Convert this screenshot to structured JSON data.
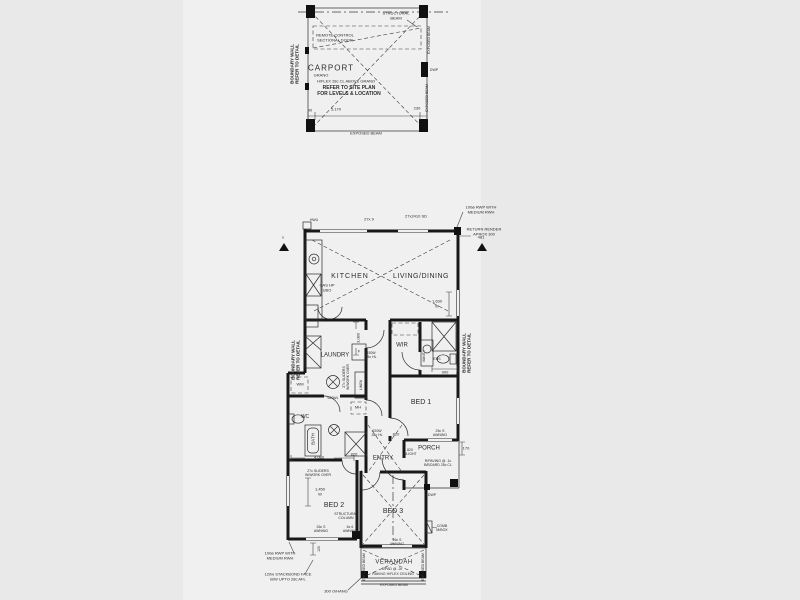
{
  "drawing_type": "residential floor plan",
  "colors": {
    "paper": "#f0f0f0",
    "margin": "#e9e9e9",
    "ink": "#181818"
  },
  "rooms": [
    "CARPORT",
    "KITCHEN",
    "LIVING/DINING",
    "LAUNDRY",
    "WIR",
    "BED 1",
    "BED 2",
    "BED 3",
    "ENTRY",
    "PORCH",
    "VERANDAH",
    "WC",
    "BATH",
    "ENS"
  ],
  "labels": [
    {
      "n": "boundary-wall-carport-label",
      "t": "BOUNDARY WALL\nREFER TO DETAIL",
      "x": 295,
      "y": 64,
      "s": 4.5,
      "r": -90,
      "b": 1
    },
    {
      "n": "structural-beam-label",
      "t": "STRUCTURAL\nBEAM",
      "x": 396,
      "y": 16,
      "s": 4
    },
    {
      "n": "remote-sectional-door-label",
      "t": "REMOTE CONTROL\nSECTIONAL DOOR",
      "x": 335,
      "y": 38,
      "s": 4
    },
    {
      "n": "room-label-carport",
      "t": "CARPORT",
      "x": 331,
      "y": 68,
      "s": 8,
      "ls": 1
    },
    {
      "n": "carport-grano-note",
      "t": "GRANO",
      "x": 321,
      "y": 76,
      "s": 4
    },
    {
      "n": "carport-hflex-note",
      "t": "H/FLEX 28c CL ABOVE GRANO",
      "x": 346,
      "y": 82,
      "s": 4
    },
    {
      "n": "carport-siteplan-note",
      "t": "REFER TO SITE PLAN\nFOR LEVELS & LOCATION",
      "x": 349,
      "y": 92,
      "s": 5,
      "b": 1
    },
    {
      "n": "exposed-beam-carport-right-1",
      "t": "EXPOSED BEAM",
      "x": 429,
      "y": 40,
      "s": 3.5,
      "r": -90
    },
    {
      "n": "exposed-beam-carport-right-2",
      "t": "EXPOSED BEAM",
      "x": 427,
      "y": 98,
      "s": 3.5,
      "r": -90
    },
    {
      "n": "dwp-carport-label",
      "t": "DWP",
      "x": 434,
      "y": 70,
      "s": 3.5
    },
    {
      "n": "carport-dim-90",
      "t": "90",
      "x": 310,
      "y": 111,
      "s": 4
    },
    {
      "n": "carport-dim-5170",
      "t": "5,170",
      "x": 336,
      "y": 110,
      "s": 4
    },
    {
      "n": "carport-dim-230",
      "t": "230",
      "x": 417,
      "y": 109,
      "s": 4
    },
    {
      "n": "exposed-beam-carport-bottom",
      "t": "EXPOSED BEAM",
      "x": 366,
      "y": 134,
      "s": 4
    },
    {
      "n": "hwu-label",
      "t": "HWU",
      "x": 314,
      "y": 220,
      "s": 3.5
    },
    {
      "n": "window-dim-27x9",
      "t": "27x 9",
      "x": 369,
      "y": 220,
      "s": 4
    },
    {
      "n": "window-dim-27x2410-sd",
      "t": "27x2410 SD",
      "x": 416,
      "y": 217,
      "s": 4
    },
    {
      "n": "rwp-top-note",
      "t": "100ø RWP WITH\nMEDIUM RWH",
      "x": 481,
      "y": 210,
      "s": 4
    },
    {
      "n": "return-render-note",
      "t": "RETURN RENDER\nAPROX 300",
      "x": 484,
      "y": 232,
      "s": 4
    },
    {
      "n": "triangle-x-left",
      "t": "x",
      "x": 283,
      "y": 238,
      "s": 4
    },
    {
      "n": "triangle-x-right",
      "t": "481",
      "x": 481,
      "y": 238,
      "s": 4
    },
    {
      "n": "room-label-kitchen",
      "t": "KITCHEN",
      "x": 350,
      "y": 277,
      "s": 7,
      "ls": 1
    },
    {
      "n": "kitchen-gas-hp-ubo",
      "t": "GAS HP\nUBO",
      "x": 327,
      "y": 288,
      "s": 4
    },
    {
      "n": "room-label-living-dining",
      "t": "LIVING/DINING",
      "x": 421,
      "y": 277,
      "s": 7,
      "ls": 0.5
    },
    {
      "n": "window-dim-1630",
      "t": "1,630\nW",
      "x": 437,
      "y": 304,
      "s": 4
    },
    {
      "n": "boundary-wall-left-label",
      "t": "BOUNDARY WALL\nREFER TO DETAIL",
      "x": 296,
      "y": 360,
      "s": 4.5,
      "r": -90,
      "b": 1
    },
    {
      "n": "room-label-laundry",
      "t": "LAUNDRY",
      "x": 335,
      "y": 356,
      "s": 6
    },
    {
      "n": "fridge-label",
      "t": "F",
      "x": 359,
      "y": 352,
      "s": 4
    },
    {
      "n": "linen-label",
      "t": "LINEN",
      "x": 361,
      "y": 385,
      "s": 3.5,
      "r": -90
    },
    {
      "n": "laundry-sliders-note",
      "t": "27c SLIDERS\nW/WORK OVER",
      "x": 346,
      "y": 377,
      "s": 3.5,
      "r": -90
    },
    {
      "n": "wm-label",
      "t": "WM",
      "x": 300,
      "y": 385,
      "s": 4
    },
    {
      "n": "dim-3080",
      "t": "3,080",
      "x": 359,
      "y": 338,
      "s": 4,
      "r": -90
    },
    {
      "n": "window-dim-930w",
      "t": "930W\n25c HL",
      "x": 371,
      "y": 355,
      "s": 3.5
    },
    {
      "n": "room-label-wir",
      "t": "WIR",
      "x": 402,
      "y": 346,
      "s": 6
    },
    {
      "n": "vanity-label",
      "t": "VANITY",
      "x": 424,
      "y": 356,
      "s": 3.5,
      "r": -90
    },
    {
      "n": "ens-label",
      "t": "ENS",
      "x": 437,
      "y": 359,
      "s": 3.5
    },
    {
      "n": "dim-900",
      "t": "900",
      "x": 445,
      "y": 373,
      "s": 4
    },
    {
      "n": "boundary-wall-right-label",
      "t": "BOUNDARY WALL\nREFER TO DETAIL",
      "x": 467,
      "y": 353,
      "s": 4.5,
      "r": -90,
      "b": 1
    },
    {
      "n": "room-label-bed1",
      "t": "BED 1",
      "x": 421,
      "y": 403,
      "s": 7
    },
    {
      "n": "room-label-wc",
      "t": "WC",
      "x": 305,
      "y": 418,
      "s": 5
    },
    {
      "n": "mh-label",
      "t": "MH",
      "x": 358,
      "y": 408,
      "s": 4
    },
    {
      "n": "window-dim-620wl",
      "t": "620WL",
      "x": 333,
      "y": 398,
      "s": 3.5
    },
    {
      "n": "room-label-bath",
      "t": "BATH",
      "x": 313,
      "y": 439,
      "s": 4.5,
      "r": -90
    },
    {
      "n": "dim-4080",
      "t": "4,080",
      "x": 319,
      "y": 458,
      "s": 4
    },
    {
      "n": "door-dim-820-bed2",
      "t": "820",
      "x": 354,
      "y": 455,
      "s": 4
    },
    {
      "n": "room-label-entry",
      "t": "ENTRY",
      "x": 383,
      "y": 459,
      "s": 6
    },
    {
      "n": "window-dim-920w",
      "t": "920W\n28c HL",
      "x": 377,
      "y": 433,
      "s": 3.5
    },
    {
      "n": "door-dim-820-hall",
      "t": "820",
      "x": 396,
      "y": 435,
      "s": 4
    },
    {
      "n": "door-dim-820-llight",
      "t": "820\nL/LIGHT",
      "x": 410,
      "y": 452,
      "s": 3.5
    },
    {
      "n": "room-label-porch",
      "t": "PORCH",
      "x": 429,
      "y": 449,
      "s": 6
    },
    {
      "n": "porch-paving-note",
      "t": "R/PAVING @ -1c\nB/BOARD 28c CL",
      "x": 438,
      "y": 463,
      "s": 3.5
    },
    {
      "n": "awning-porch-note",
      "t": "25c S\nAWNING",
      "x": 440,
      "y": 433,
      "s": 3.5
    },
    {
      "n": "dim-170",
      "t": "170",
      "x": 466,
      "y": 449,
      "s": 4
    },
    {
      "n": "dwp-porch-label",
      "t": "DWP",
      "x": 432,
      "y": 495,
      "s": 3.5
    },
    {
      "n": "room-label-bed2",
      "t": "BED 2",
      "x": 334,
      "y": 506,
      "s": 7
    },
    {
      "n": "bed2-sliders-note",
      "t": "27c SLIDERS\nW/WORK OVER",
      "x": 318,
      "y": 473,
      "s": 3.5
    },
    {
      "n": "window-dim-1450",
      "t": "1,450\nW",
      "x": 320,
      "y": 492,
      "s": 4
    },
    {
      "n": "structural-column-label",
      "t": "STRUCTURAL\nCOLUMN",
      "x": 346,
      "y": 516,
      "s": 3.5
    },
    {
      "n": "awning-6x6-note",
      "t": "6x 6\nAWNING",
      "x": 350,
      "y": 529,
      "s": 3.5
    },
    {
      "n": "awning-bed2-note",
      "t": "26c S\nAWNING",
      "x": 321,
      "y": 529,
      "s": 3.5
    },
    {
      "n": "room-label-bed3",
      "t": "BED 3",
      "x": 393,
      "y": 512,
      "s": 7
    },
    {
      "n": "awning-bed3-note",
      "t": "26c S\nAWNING",
      "x": 397,
      "y": 542,
      "s": 3.5
    },
    {
      "n": "comb-mbox-label",
      "t": "COMB\nM/BOX",
      "x": 442,
      "y": 528,
      "s": 3.5
    },
    {
      "n": "room-label-verandah",
      "t": "VERANDAH",
      "x": 394,
      "y": 563,
      "s": 6,
      "ls": 0.5
    },
    {
      "n": "verandah-spad-note",
      "t": "S/PAD @ -2c",
      "x": 392,
      "y": 569,
      "s": 3.5
    },
    {
      "n": "verandah-raking-note",
      "t": "RAKING H/FLEX CEILING",
      "x": 393,
      "y": 574,
      "s": 3.5
    },
    {
      "n": "exposed-beam-verandah-bottom",
      "t": "EXPOSED BEAM",
      "x": 394,
      "y": 585,
      "s": 3.5
    },
    {
      "n": "exposed-beam-verandah-left",
      "t": "EXPOSED BEAM",
      "x": 364,
      "y": 567,
      "s": 3.5,
      "r": -90
    },
    {
      "n": "exposed-beam-verandah-right",
      "t": "EXPOSED BEAM",
      "x": 423,
      "y": 567,
      "s": 3.5,
      "r": -90
    },
    {
      "n": "rwp-bottom-note",
      "t": "100ø RWP WITH\nMEDIUM RWH",
      "x": 280,
      "y": 556,
      "s": 4
    },
    {
      "n": "stackbond-note",
      "t": "120w STACKBOND FACE\nB/W UPTO 28c AFL",
      "x": 288,
      "y": 577,
      "s": 4
    },
    {
      "n": "dim-120",
      "t": "120",
      "x": 319,
      "y": 549,
      "s": 3.5,
      "r": -90
    },
    {
      "n": "overhang-note",
      "t": "300 O/HANG",
      "x": 336,
      "y": 592,
      "s": 4
    }
  ]
}
